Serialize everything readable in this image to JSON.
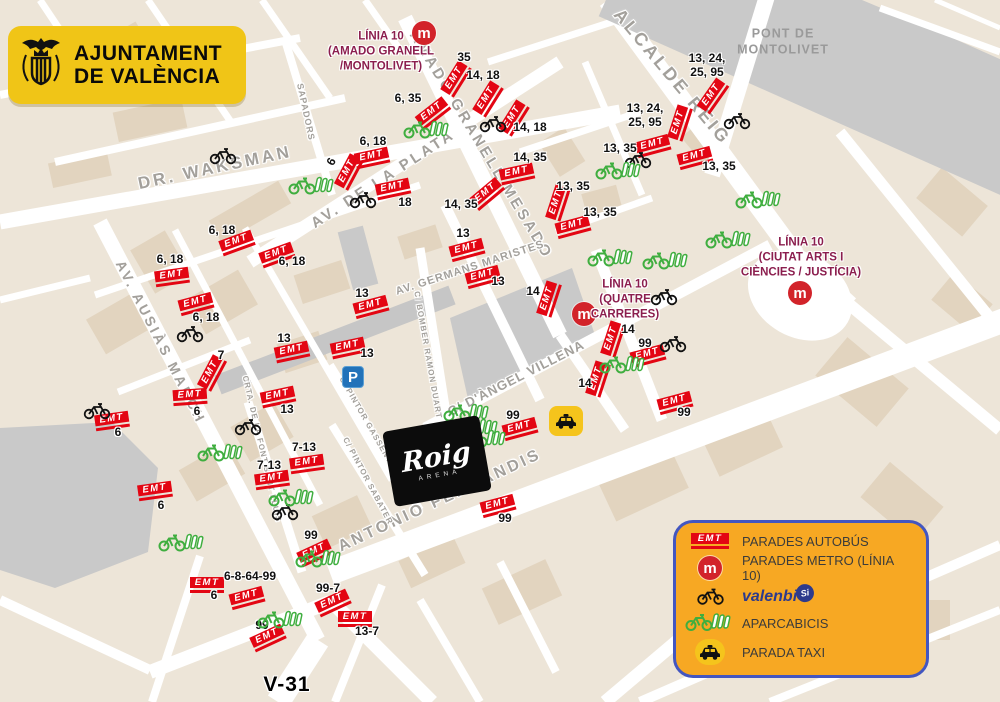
{
  "colors": {
    "emt_red": "#E30613",
    "metro_red": "#D2232A",
    "linia_maroon": "#8B1E4E",
    "legend_bg": "#F7A823",
    "legend_border": "#4356C0",
    "valenbisi_blue": "#2D3A8C",
    "green": "#3FAE3F",
    "taxi_yellow": "#F5C41C",
    "parking_blue": "#2272B9",
    "map_bg": "#EDE5D8",
    "road_gray": "#C9C9C9",
    "street_text_gray": "#A3A09B"
  },
  "icons": {
    "emt_text": "EMT",
    "metro_letter": "m",
    "parking_letter": "P"
  },
  "city_logo": {
    "line1": "AJUNTAMENT",
    "line2": "DE VALÈNCIA"
  },
  "arena": {
    "title": "Roig",
    "subtitle": "ARENA"
  },
  "v31": {
    "text": "V-31",
    "x": 287,
    "y": 685
  },
  "pont": {
    "text": "PONT DE\nMONTOLIVET",
    "x": 783,
    "y": 42
  },
  "legend": {
    "items": [
      {
        "icon": "emt",
        "label": "PARADES AUTOBÚS"
      },
      {
        "icon": "metro",
        "label": "PARADES METRO (LÍNIA 10)"
      },
      {
        "icon": "valenbisi",
        "label": "valenbi",
        "suffix": "Si"
      },
      {
        "icon": "aparcabicis",
        "label": "APARCABICIS"
      },
      {
        "icon": "taxi",
        "label": "PARADA TAXI"
      }
    ]
  },
  "streets": [
    {
      "text": "DR. WAKSMAN",
      "x": 215,
      "y": 168,
      "rot": -12,
      "size": 17
    },
    {
      "text": "AV. DE LA PLATA",
      "x": 383,
      "y": 179,
      "rot": -33,
      "size": 15
    },
    {
      "text": "AV.  AUSIÀS  MARCH",
      "x": 161,
      "y": 342,
      "rot": 63,
      "size": 14
    },
    {
      "text": "AMADO GRANELL MESADO",
      "x": 481,
      "y": 145,
      "rot": 59,
      "size": 15
    },
    {
      "text": "ALCALDE REIG",
      "x": 672,
      "y": 77,
      "rot": 50,
      "size": 18
    },
    {
      "text": "AV. GERMANS MARISTES",
      "x": 470,
      "y": 268,
      "rot": -18,
      "size": 11
    },
    {
      "text": "C/ D'ÀNGEL VILLENA",
      "x": 516,
      "y": 378,
      "rot": -27,
      "size": 13
    },
    {
      "text": "ANTONIO FERRANDIS",
      "x": 440,
      "y": 501,
      "rot": -25,
      "size": 16
    },
    {
      "text": "SAPADORS",
      "x": 306,
      "y": 112,
      "rot": 78,
      "size": 9
    },
    {
      "text": "C/ BOMBER RAMON DUART",
      "x": 428,
      "y": 355,
      "rot": 80,
      "size": 8
    },
    {
      "text": "C/ PINTOR GASSENT",
      "x": 366,
      "y": 420,
      "rot": 60,
      "size": 8
    },
    {
      "text": "C/ PINTOR SABATER",
      "x": 368,
      "y": 481,
      "rot": 62,
      "size": 8
    },
    {
      "text": "CRTA. DE LA FONT SANT LLUÍS",
      "x": 262,
      "y": 449,
      "rot": 77,
      "size": 8
    }
  ],
  "metro_stations": [
    {
      "x": 424,
      "y": 33,
      "label": "LÍNIA 10\n(AMADO GRANELL\n/MONTOLIVET)",
      "lx": 381,
      "ly": 52
    },
    {
      "x": 584,
      "y": 314,
      "label": "LÍNIA 10\n(QUATRE\nCARRERES)",
      "lx": 625,
      "ly": 300
    },
    {
      "x": 800,
      "y": 293,
      "label": "LÍNIA 10\n(CIUTAT ARTS I\nCIÈNCIES / JUSTÍCIA)",
      "lx": 801,
      "ly": 258
    }
  ],
  "bus_stops": [
    {
      "x": 456,
      "y": 79,
      "rot": -58
    },
    {
      "x": 488,
      "y": 99,
      "rot": -58
    },
    {
      "x": 514,
      "y": 118,
      "rot": -58
    },
    {
      "x": 433,
      "y": 113,
      "rot": -38
    },
    {
      "x": 349,
      "y": 172,
      "rot": -62
    },
    {
      "x": 372,
      "y": 158,
      "rot": -12
    },
    {
      "x": 393,
      "y": 189,
      "rot": -12
    },
    {
      "x": 487,
      "y": 194,
      "rot": -40
    },
    {
      "x": 517,
      "y": 174,
      "rot": -12
    },
    {
      "x": 713,
      "y": 96,
      "rot": -55
    },
    {
      "x": 680,
      "y": 123,
      "rot": -72
    },
    {
      "x": 653,
      "y": 146,
      "rot": -15
    },
    {
      "x": 695,
      "y": 158,
      "rot": -15
    },
    {
      "x": 558,
      "y": 203,
      "rot": -72
    },
    {
      "x": 573,
      "y": 227,
      "rot": -15
    },
    {
      "x": 467,
      "y": 250,
      "rot": -15
    },
    {
      "x": 483,
      "y": 277,
      "rot": -15
    },
    {
      "x": 371,
      "y": 307,
      "rot": -15
    },
    {
      "x": 292,
      "y": 352,
      "rot": -12
    },
    {
      "x": 348,
      "y": 348,
      "rot": -12
    },
    {
      "x": 278,
      "y": 397,
      "rot": -12
    },
    {
      "x": 549,
      "y": 299,
      "rot": -72
    },
    {
      "x": 613,
      "y": 339,
      "rot": -72
    },
    {
      "x": 648,
      "y": 356,
      "rot": -15
    },
    {
      "x": 598,
      "y": 379,
      "rot": -72
    },
    {
      "x": 675,
      "y": 403,
      "rot": -15
    },
    {
      "x": 520,
      "y": 429,
      "rot": -15
    },
    {
      "x": 498,
      "y": 506,
      "rot": -15
    },
    {
      "x": 172,
      "y": 277,
      "rot": -8
    },
    {
      "x": 237,
      "y": 243,
      "rot": -20
    },
    {
      "x": 277,
      "y": 255,
      "rot": -20
    },
    {
      "x": 196,
      "y": 304,
      "rot": -15
    },
    {
      "x": 212,
      "y": 373,
      "rot": -62
    },
    {
      "x": 190,
      "y": 397,
      "rot": -4
    },
    {
      "x": 112,
      "y": 421,
      "rot": -8
    },
    {
      "x": 155,
      "y": 491,
      "rot": -8
    },
    {
      "x": 307,
      "y": 464,
      "rot": -8
    },
    {
      "x": 272,
      "y": 480,
      "rot": -8
    },
    {
      "x": 315,
      "y": 553,
      "rot": -25
    },
    {
      "x": 207,
      "y": 585,
      "rot": 0
    },
    {
      "x": 247,
      "y": 598,
      "rot": -15
    },
    {
      "x": 333,
      "y": 603,
      "rot": -25
    },
    {
      "x": 268,
      "y": 638,
      "rot": -25
    },
    {
      "x": 355,
      "y": 619,
      "rot": 0
    }
  ],
  "route_labels": [
    {
      "text": "35",
      "x": 464,
      "y": 58
    },
    {
      "text": "14, 18",
      "x": 483,
      "y": 76
    },
    {
      "text": "14, 18",
      "x": 530,
      "y": 128
    },
    {
      "text": "6, 35",
      "x": 408,
      "y": 99
    },
    {
      "text": "6",
      "x": 332,
      "y": 162,
      "rot": -62
    },
    {
      "text": "6, 18",
      "x": 373,
      "y": 142
    },
    {
      "text": "18",
      "x": 405,
      "y": 203
    },
    {
      "text": "14, 35",
      "x": 461,
      "y": 205
    },
    {
      "text": "14, 35",
      "x": 530,
      "y": 158
    },
    {
      "text": "13, 24,\n25, 95",
      "x": 707,
      "y": 66
    },
    {
      "text": "13, 24,\n25, 95",
      "x": 645,
      "y": 116
    },
    {
      "text": "13, 35",
      "x": 620,
      "y": 149
    },
    {
      "text": "13, 35",
      "x": 719,
      "y": 167
    },
    {
      "text": "13, 35",
      "x": 573,
      "y": 187
    },
    {
      "text": "13, 35",
      "x": 600,
      "y": 213
    },
    {
      "text": "13",
      "x": 463,
      "y": 234
    },
    {
      "text": "13",
      "x": 498,
      "y": 282
    },
    {
      "text": "13",
      "x": 362,
      "y": 294
    },
    {
      "text": "13",
      "x": 284,
      "y": 339
    },
    {
      "text": "13",
      "x": 367,
      "y": 354
    },
    {
      "text": "13",
      "x": 287,
      "y": 410
    },
    {
      "text": "14",
      "x": 533,
      "y": 292
    },
    {
      "text": "14",
      "x": 628,
      "y": 330
    },
    {
      "text": "99",
      "x": 645,
      "y": 344
    },
    {
      "text": "14",
      "x": 585,
      "y": 384
    },
    {
      "text": "99",
      "x": 684,
      "y": 413
    },
    {
      "text": "99",
      "x": 513,
      "y": 416
    },
    {
      "text": "99",
      "x": 505,
      "y": 519
    },
    {
      "text": "6, 18",
      "x": 170,
      "y": 260
    },
    {
      "text": "6, 18",
      "x": 222,
      "y": 231
    },
    {
      "text": "6, 18",
      "x": 292,
      "y": 262
    },
    {
      "text": "6, 18",
      "x": 206,
      "y": 318
    },
    {
      "text": "7",
      "x": 221,
      "y": 356
    },
    {
      "text": "6",
      "x": 197,
      "y": 412
    },
    {
      "text": "6",
      "x": 118,
      "y": 433
    },
    {
      "text": "6",
      "x": 161,
      "y": 506
    },
    {
      "text": "7-13",
      "x": 304,
      "y": 448
    },
    {
      "text": "7-13",
      "x": 269,
      "y": 466
    },
    {
      "text": "99",
      "x": 311,
      "y": 536
    },
    {
      "text": "6-8-64-99",
      "x": 250,
      "y": 577
    },
    {
      "text": "6",
      "x": 214,
      "y": 596
    },
    {
      "text": "99-7",
      "x": 328,
      "y": 589
    },
    {
      "text": "99",
      "x": 262,
      "y": 626
    },
    {
      "text": "13-7",
      "x": 367,
      "y": 632
    }
  ],
  "valenbisi_stations": [
    {
      "x": 223,
      "y": 158
    },
    {
      "x": 493,
      "y": 126
    },
    {
      "x": 363,
      "y": 202
    },
    {
      "x": 737,
      "y": 123
    },
    {
      "x": 638,
      "y": 162
    },
    {
      "x": 664,
      "y": 299
    },
    {
      "x": 673,
      "y": 346
    },
    {
      "x": 190,
      "y": 336
    },
    {
      "x": 97,
      "y": 413
    },
    {
      "x": 248,
      "y": 429
    },
    {
      "x": 285,
      "y": 514
    }
  ],
  "aparcabicis_stations": [
    {
      "x": 428,
      "y": 132
    },
    {
      "x": 313,
      "y": 188
    },
    {
      "x": 620,
      "y": 173
    },
    {
      "x": 760,
      "y": 202
    },
    {
      "x": 730,
      "y": 242
    },
    {
      "x": 612,
      "y": 260
    },
    {
      "x": 667,
      "y": 263
    },
    {
      "x": 624,
      "y": 367
    },
    {
      "x": 293,
      "y": 500
    },
    {
      "x": 222,
      "y": 455
    },
    {
      "x": 183,
      "y": 545
    },
    {
      "x": 320,
      "y": 561
    },
    {
      "x": 282,
      "y": 622
    },
    {
      "x": 468,
      "y": 415
    },
    {
      "x": 477,
      "y": 430
    },
    {
      "x": 485,
      "y": 441
    }
  ],
  "taxi_stands": [
    {
      "x": 566,
      "y": 421
    }
  ],
  "parking": [
    {
      "x": 353,
      "y": 377
    }
  ]
}
